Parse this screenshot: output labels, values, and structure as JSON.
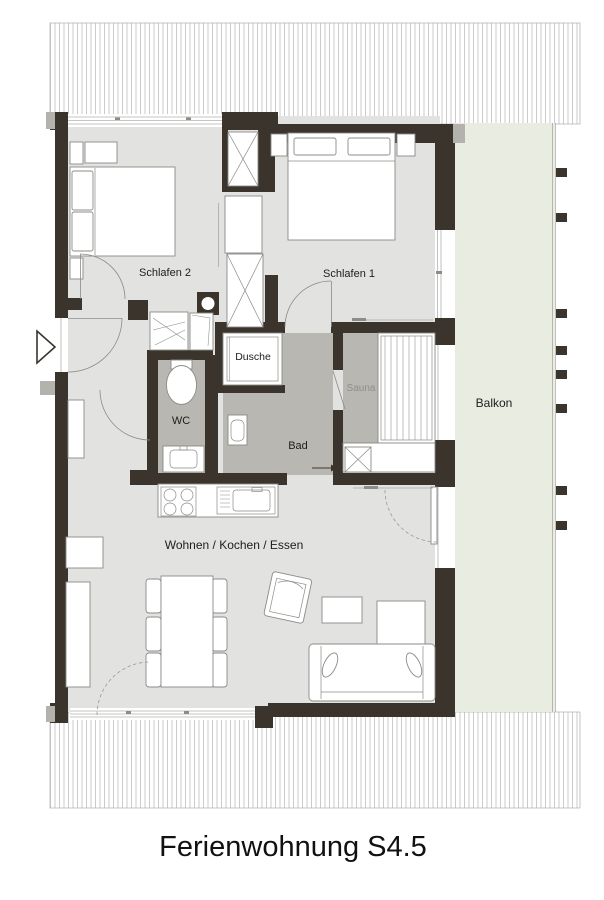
{
  "plan": {
    "caption": "Ferienwohnung S4.5",
    "rooms": {
      "schlafen2": "Schlafen 2",
      "schlafen1": "Schlafen 1",
      "dusche": "Dusche",
      "wc": "WC",
      "bad": "Bad",
      "sauna": "Sauna",
      "balkon": "Balkon",
      "wohnen": "Wohnen / Kochen / Essen"
    },
    "colors": {
      "wall": "#3a342d",
      "floor": "#e2e2e1",
      "wet": "#b9b7b2",
      "balcony": "#e9ece1",
      "hatch": "#a8a8a8",
      "outline": "#8b8b87",
      "label": "#1d1d1b",
      "label_muted": "#908e89"
    }
  }
}
